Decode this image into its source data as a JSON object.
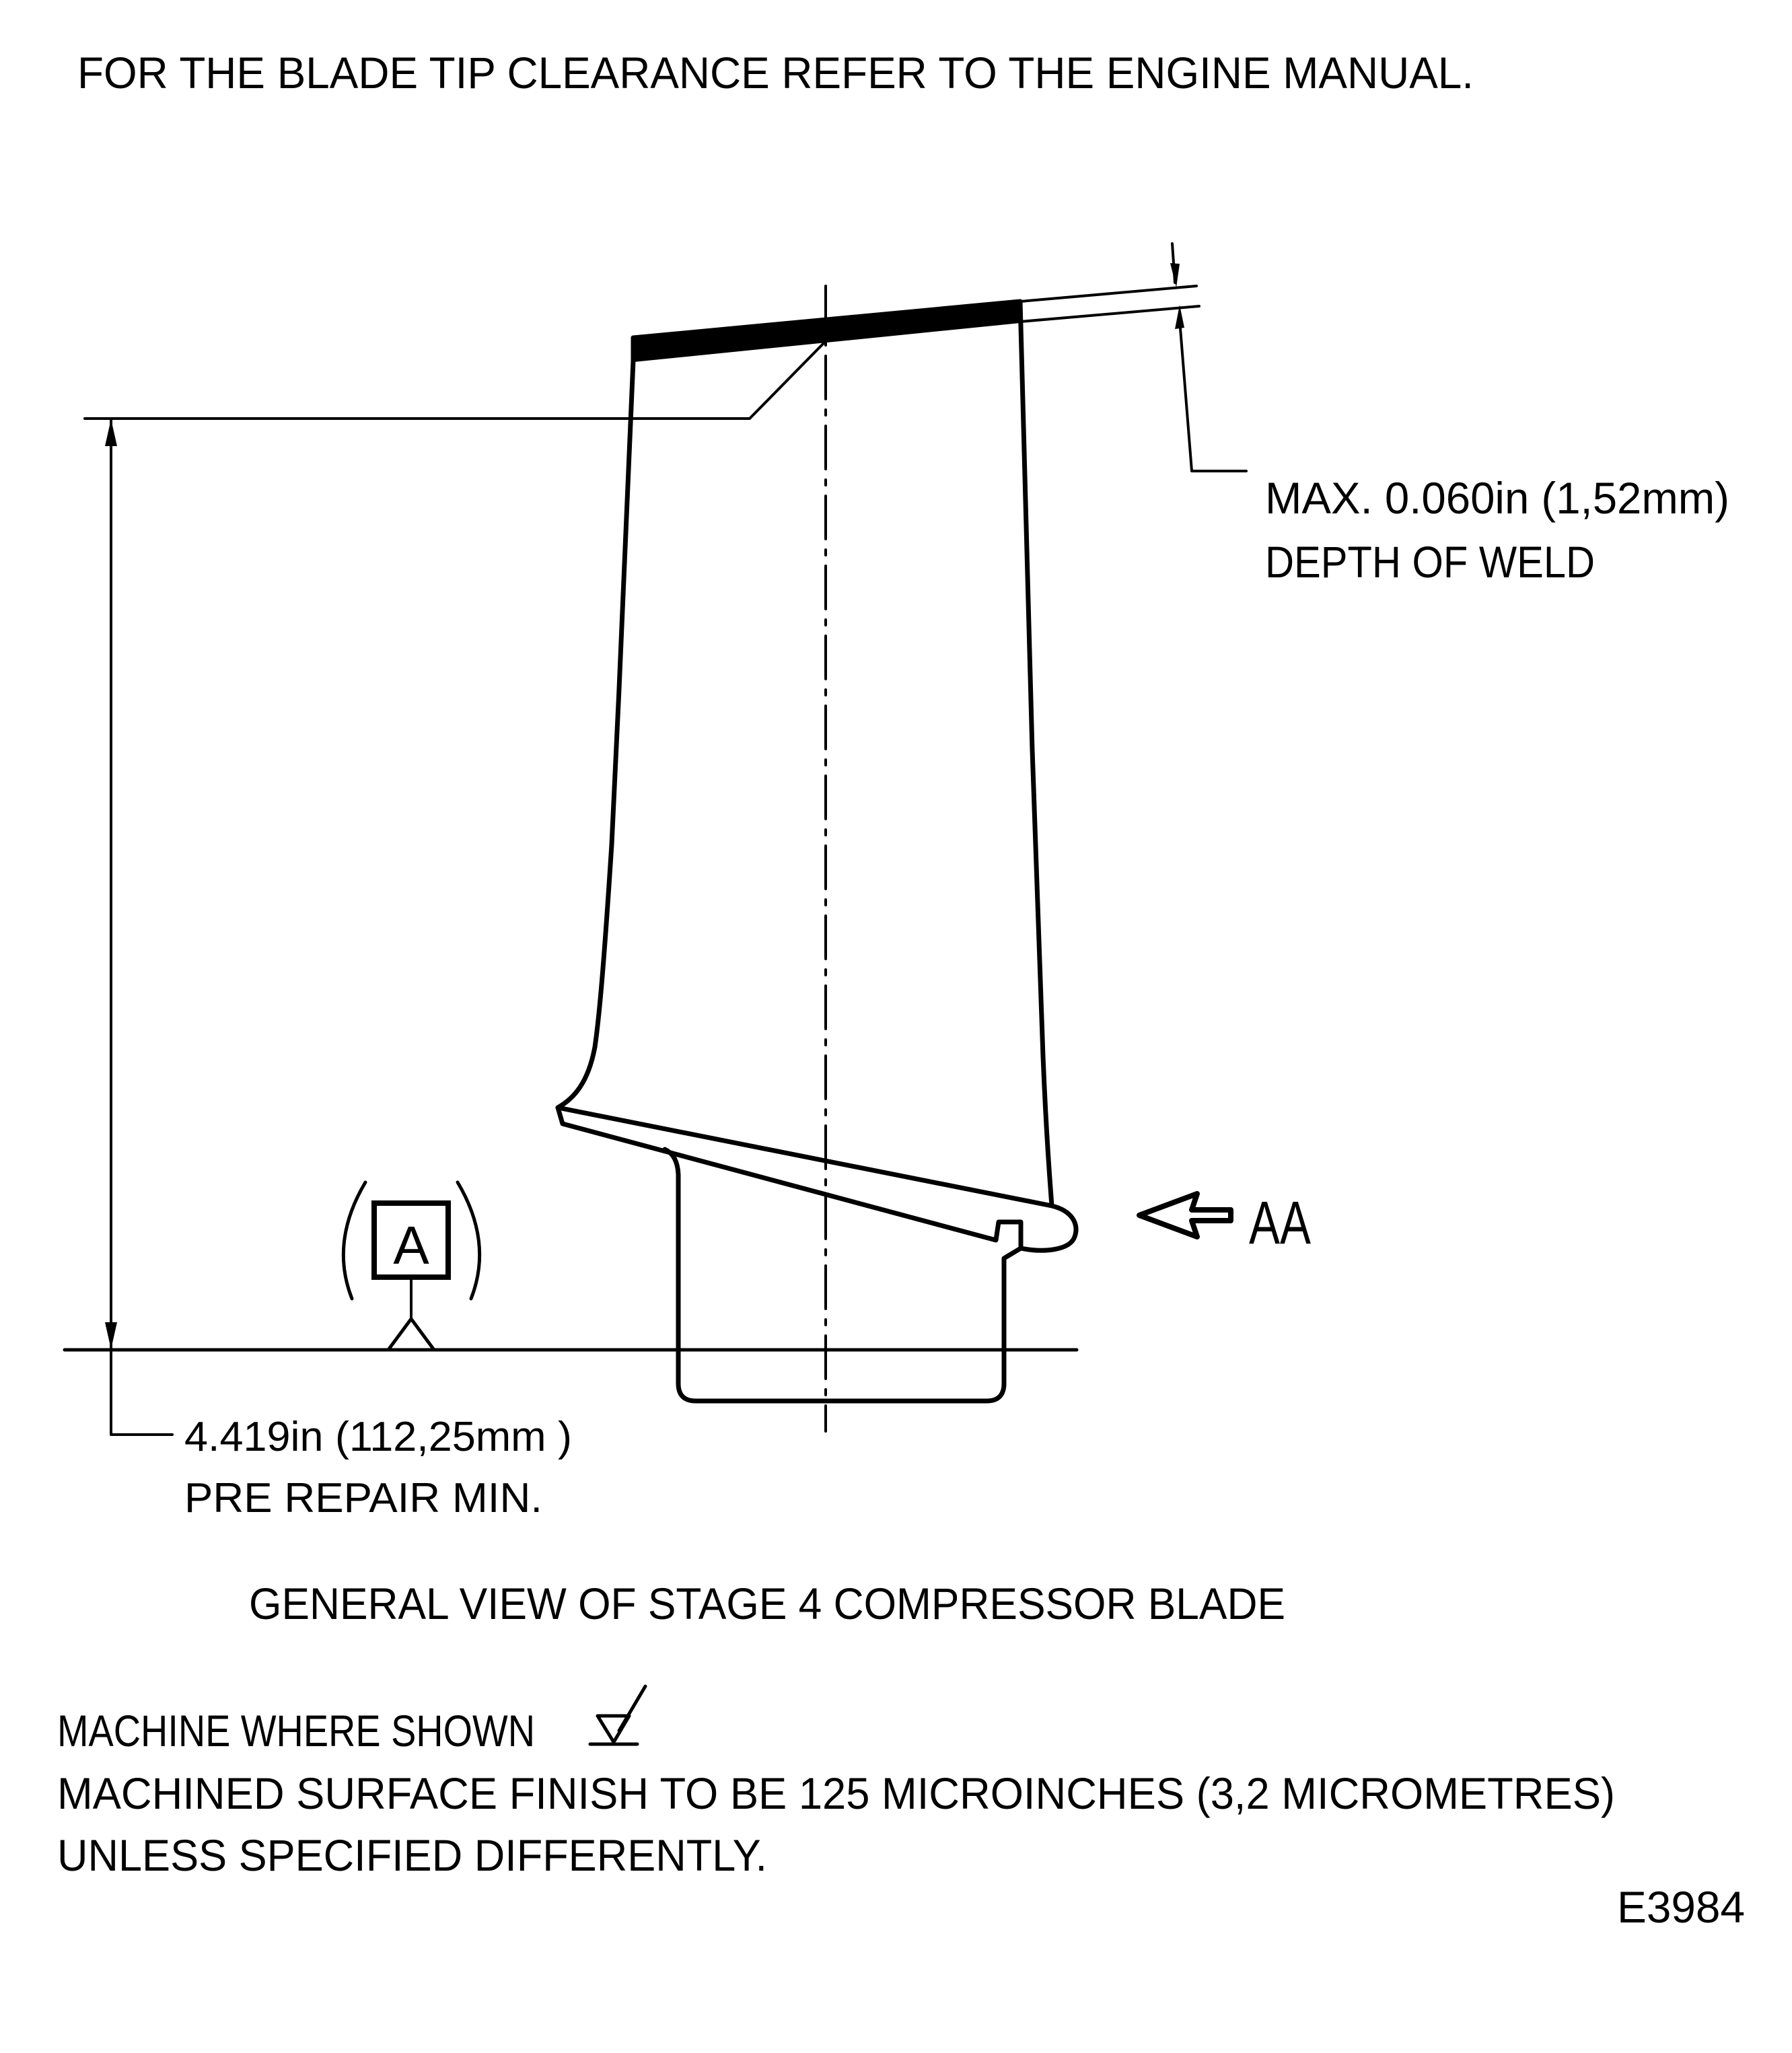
{
  "title": "FOR THE BLADE TIP CLEARANCE REFER TO THE ENGINE MANUAL.",
  "weld_dimension": {
    "value_line": "MAX. 0.060in (1,52mm)",
    "label_line": "DEPTH OF WELD"
  },
  "height_dimension": {
    "value_line": "4.419in (112,25mm )",
    "label_line": "PRE REPAIR MIN."
  },
  "datum": {
    "label": "A"
  },
  "section_view": {
    "label": "AA"
  },
  "caption": "GENERAL VIEW OF STAGE 4 COMPRESSOR BLADE",
  "notes": {
    "machine_note": "MACHINE WHERE SHOWN",
    "surface_finish_note": "MACHINED SURFACE FINISH TO BE 125 MICROINCHES (3,2 MICROMETRES)",
    "qualifier_note": "UNLESS SPECIFIED DIFFERENTLY."
  },
  "document_number": "E3984",
  "colors": {
    "ink": "#000000",
    "paper": "#ffffff"
  }
}
